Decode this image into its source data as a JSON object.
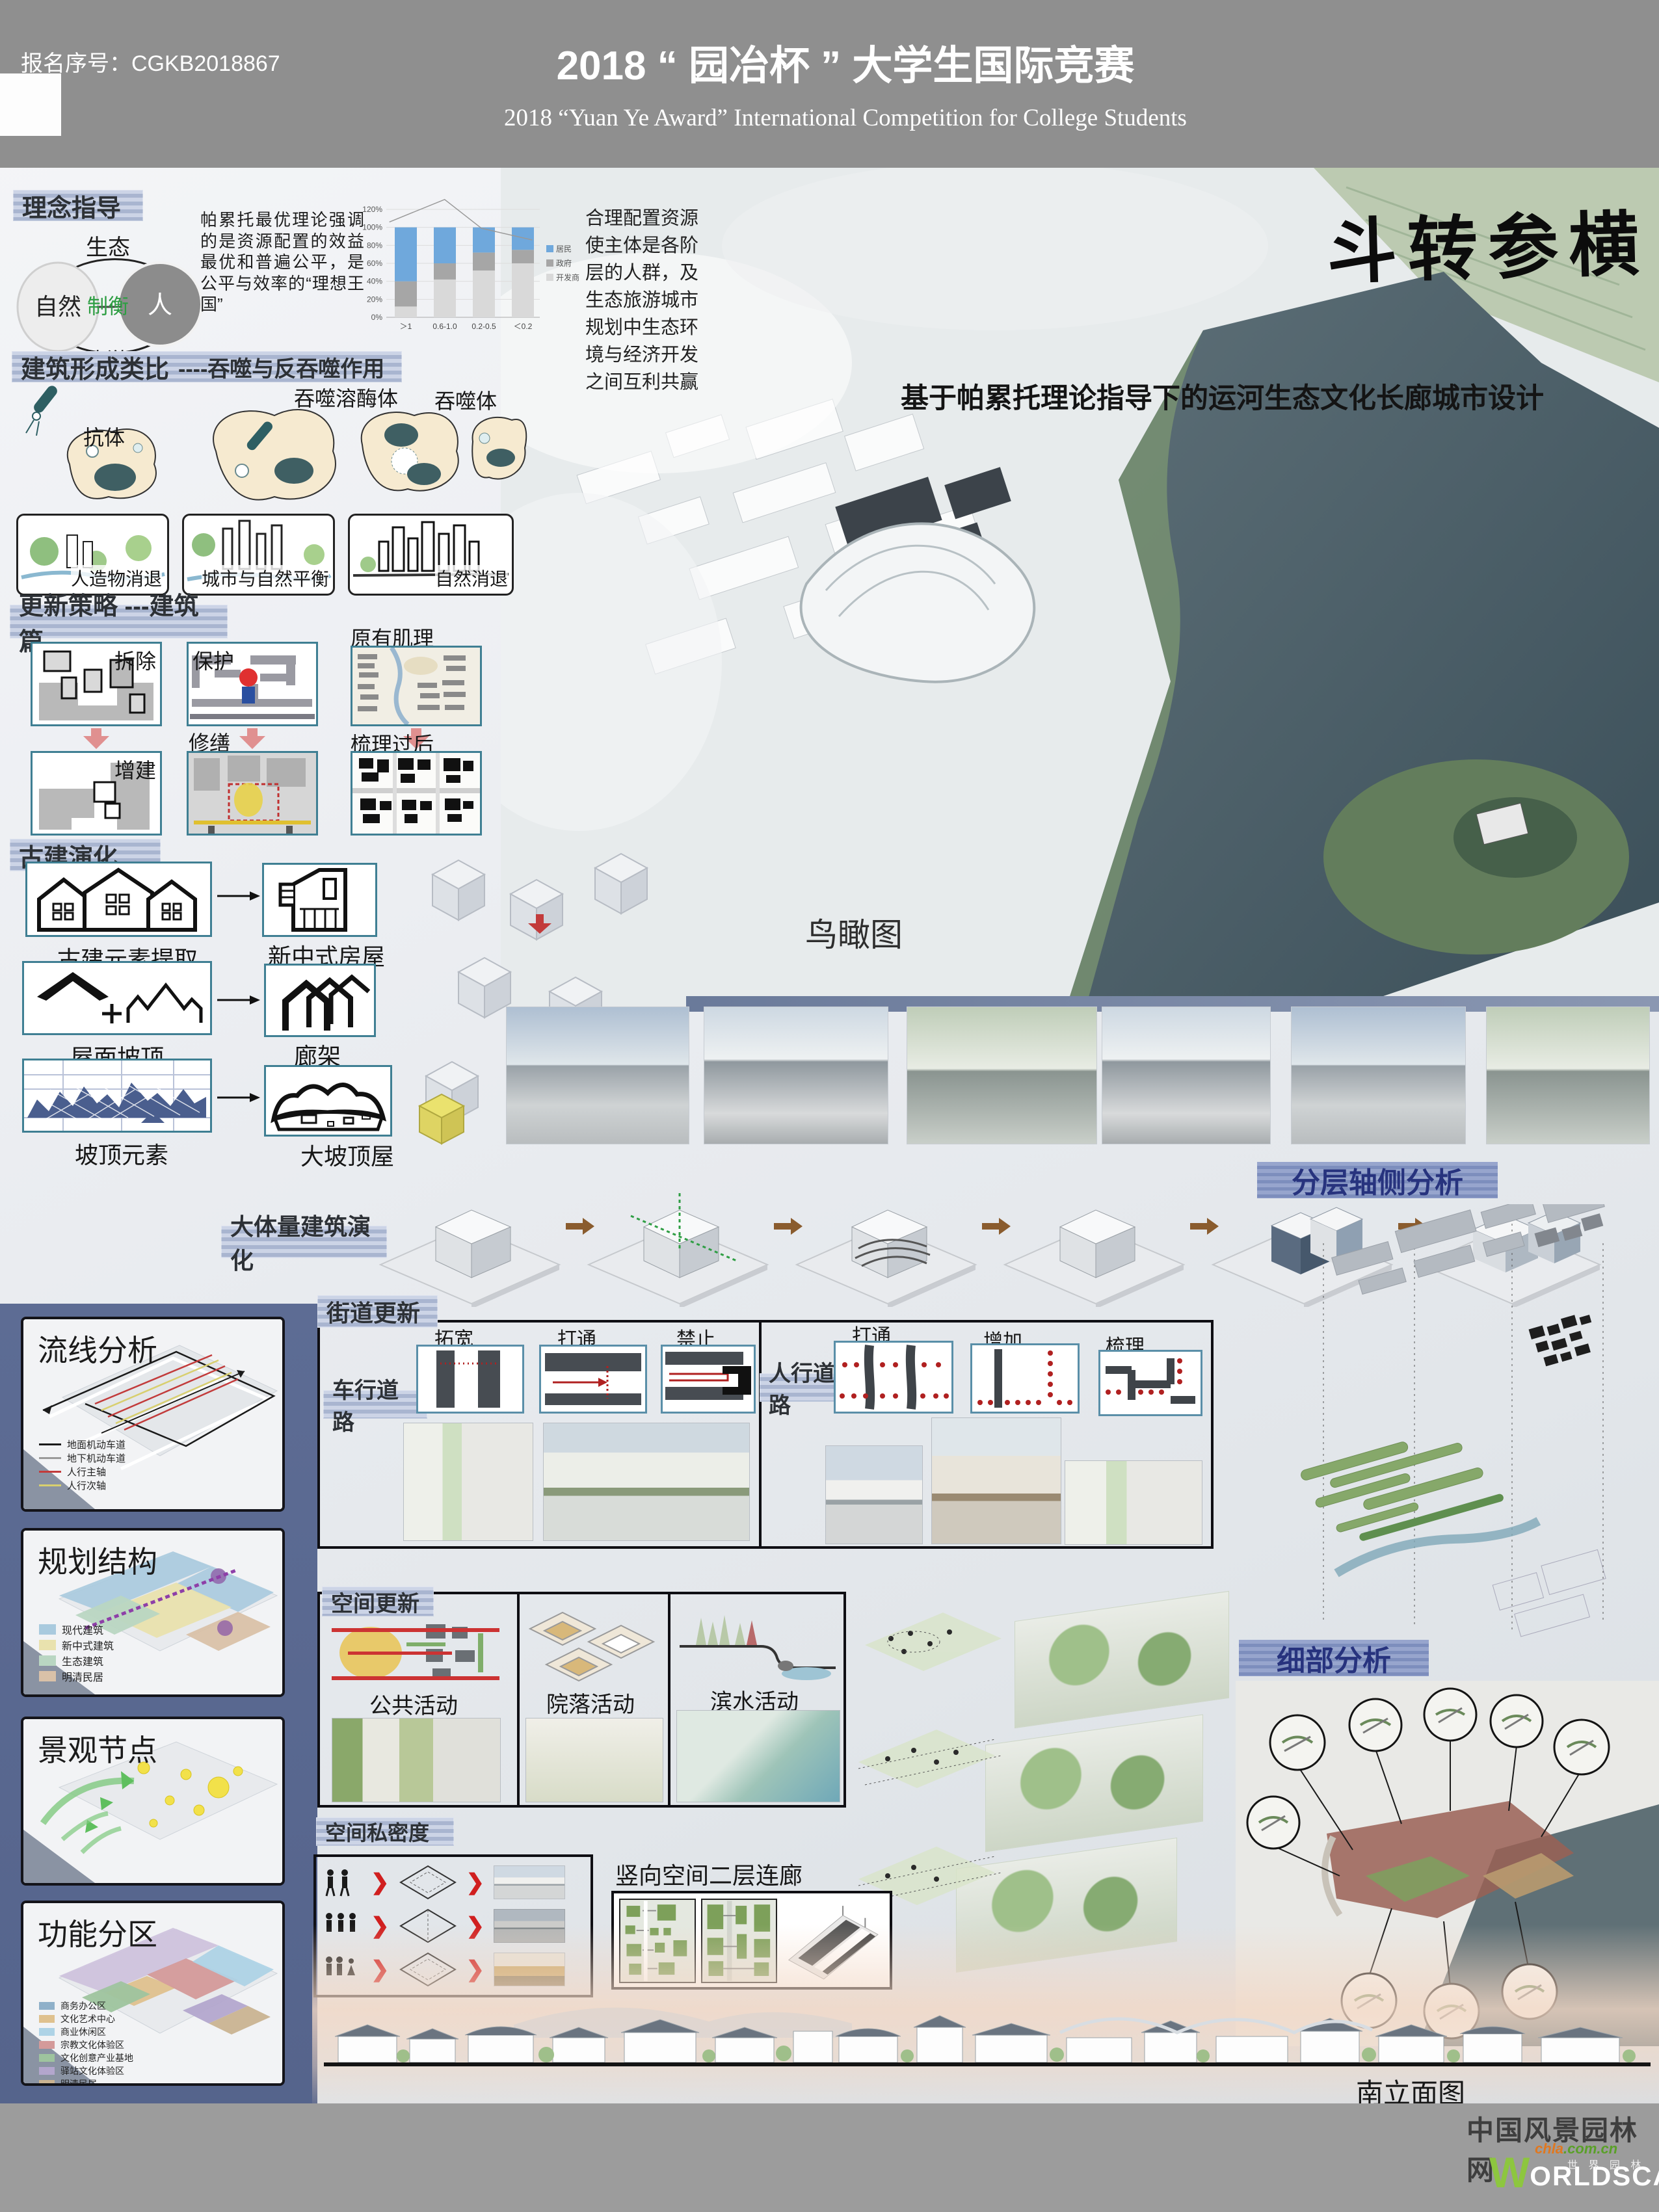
{
  "header": {
    "reg_label": "报名序号：",
    "reg_number": "CGKB2018867",
    "title_cn": "2018 “ 园冶杯 ” 大学生国际竞赛",
    "title_en": "2018 “Yuan Ye Award” International Competition for College Students"
  },
  "hero": {
    "calligraphy": "斗转参横",
    "subtitle": "基于帕累托理论指导下的运河生态文化长廊城市设计",
    "birdseye_label": "鸟瞰图"
  },
  "concept": {
    "band": "理念指导",
    "venn": {
      "left": "自然",
      "right": "人",
      "top": "生态",
      "center": "制衡",
      "bottom": "旅游"
    },
    "paragraph": "帕累托最优理论强调的是资源配置的效益最优和普遍公平，是公平与效率的“理想王国”",
    "note": "合理配置资源使主体是各阶层的人群，及生态旅游城市规划中生态环境与经济开发之间互利共赢"
  },
  "chart_data": {
    "type": "bar",
    "stacked": true,
    "title": "",
    "xlabel": "",
    "ylabel": "",
    "categories": [
      "＞1",
      "0.6-1.0",
      "0.2-0.5",
      "＜0.2"
    ],
    "series": [
      {
        "name": "开发商",
        "color": "#d9d9d9",
        "values": [
          12,
          42,
          52,
          60
        ]
      },
      {
        "name": "政府",
        "color": "#a6a6a6",
        "values": [
          28,
          18,
          20,
          15
        ]
      },
      {
        "name": "居民",
        "color": "#6fa8dc",
        "values": [
          60,
          40,
          28,
          25
        ]
      }
    ],
    "ylim": [
      0,
      120
    ],
    "ytick_step": 20,
    "grid": true,
    "legend_position": "right",
    "trend_line_pct": [
      [
        0.02,
        106
      ],
      [
        0.38,
        131
      ],
      [
        0.62,
        99
      ],
      [
        0.95,
        86
      ]
    ]
  },
  "analogy": {
    "band": "建筑形成类比",
    "band_suffix": "----吞噬与反吞噬作用",
    "cell_labels": [
      "抗体",
      "吞噬溶酶体",
      "吞噬体"
    ],
    "result_boxes": [
      "人造物消退",
      "城市与自然平衡",
      "自然消退"
    ]
  },
  "renewal": {
    "band": "更新策略 ---建筑篇",
    "demolish": "拆除",
    "protect": "保护",
    "fabric": "原有肌理",
    "repair": "修缮",
    "addition": "增建",
    "combed": "梳理过后"
  },
  "evolution": {
    "band": "古建演化",
    "rows": [
      {
        "from": "古建元素提取",
        "to": "新中式房屋"
      },
      {
        "from": "屋面坡顶",
        "to": "廊架"
      },
      {
        "from": "坡顶元素",
        "to": "大坡顶屋"
      }
    ]
  },
  "massing": {
    "band": "大体量建筑演化"
  },
  "street": {
    "band": "街道更新",
    "vehicle_label": "车行道路",
    "vehicle_items": [
      "拓宽",
      "打通",
      "禁止"
    ],
    "ped_label": "人行道路",
    "ped_items": [
      "打通",
      "增加",
      "梳理"
    ]
  },
  "space": {
    "band": "空间更新",
    "columns": [
      "公共活动",
      "院落活动",
      "滨水活动"
    ]
  },
  "privacy": {
    "band": "空间私密度"
  },
  "corridor": {
    "label": "竖向空间二层连廊"
  },
  "axon": {
    "band": "分层轴侧分析"
  },
  "detail": {
    "band": "细部分析"
  },
  "elevation": {
    "label": "南立面图"
  },
  "panels": [
    {
      "title": "流线分析",
      "legend": [
        {
          "label": "地面机动车道",
          "color": "#1a1a1a"
        },
        {
          "label": "地下机动车道",
          "color": "#9a9a9a"
        },
        {
          "label": "人行主轴",
          "color": "#c23b3b"
        },
        {
          "label": "人行次轴",
          "color": "#d8cf6e"
        }
      ]
    },
    {
      "title": "规划结构",
      "legend": [
        {
          "label": "现代建筑",
          "color": "#a9cade"
        },
        {
          "label": "新中式建筑",
          "color": "#e9e2ae"
        },
        {
          "label": "生态建筑",
          "color": "#b9d6c2"
        },
        {
          "label": "明清民居",
          "color": "#d9c1a8"
        }
      ]
    },
    {
      "title": "景观节点",
      "legend": []
    },
    {
      "title": "功能分区",
      "legend": [
        {
          "label": "商务办公区",
          "color": "#8fb0c9"
        },
        {
          "label": "文化艺术中心",
          "color": "#dfc18e"
        },
        {
          "label": "商业休闲区",
          "color": "#aed3e6"
        },
        {
          "label": "宗教文化体验区",
          "color": "#d49a9a"
        },
        {
          "label": "文化创意产业基地",
          "color": "#9ec49e"
        },
        {
          "label": "驿站文化体验区",
          "color": "#b3a6cd"
        },
        {
          "label": "明清民居",
          "color": "#c9b391"
        }
      ]
    }
  ],
  "watermark": {
    "site": "中国风景园林网",
    "url_orange": "chla",
    "url_green": ".com.cn",
    "w": "W",
    "rest": "ORLDSCAPE",
    "sub": "世 界 园 林"
  }
}
